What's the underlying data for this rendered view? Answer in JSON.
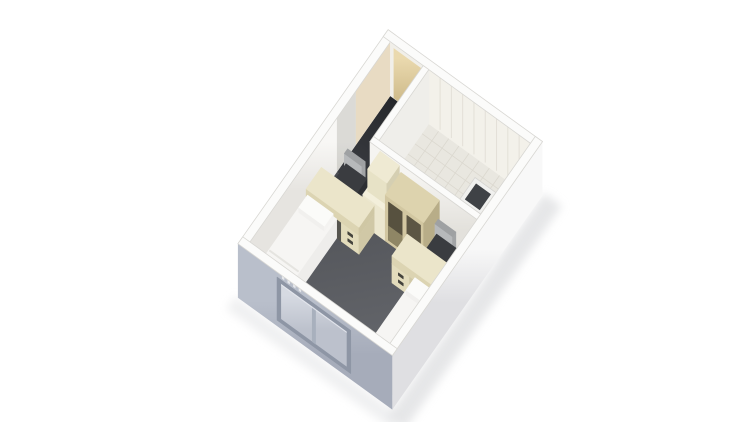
{
  "scene": {
    "name": "isometric-room-rendering",
    "canvas": {
      "width": 750,
      "height": 422,
      "background": "#ffffff"
    },
    "projection": {
      "origin": [
        250,
        296
      ],
      "eu": [
        0.54,
        -0.77
      ],
      "ev": [
        0.8,
        0.58
      ]
    },
    "room": {
      "interior_length": 260,
      "interior_width": 175,
      "wall_thickness": 9,
      "wall_height": 54
    },
    "palette": {
      "carpet_dark": "#4f5156",
      "carpet_light": "#696b70",
      "corridor_dark": "#26282c",
      "corridor_light": "#3b3d42",
      "wall_white": "#f3f2ef",
      "wall_top": "#fbfbfa",
      "wall_edge": "#d8d7d3",
      "tile_floor": "#e9e7e0",
      "tile_line": "#dbd8cf",
      "window_wall": "#aeb4c1",
      "window_frame": "#8e96a5",
      "window_pane": "#c9cdd7",
      "door_tan": "#dcc99c",
      "bed_white": "#f6f5f3",
      "desk_cream": "#ebe5ca",
      "chair_dark": "#3a3c40",
      "chair_back_gray": "#b7b9bb",
      "wardrobe_tan": "#d2c7a1",
      "shaft_dark": "#3f4246"
    },
    "gradients": [
      {
        "id": "gCarpet",
        "from": [
          161,
          10,
          0
        ],
        "to": [
          0,
          170,
          0
        ],
        "c1": "#4f5156",
        "c2": "#696b70"
      },
      {
        "id": "gCorridor",
        "from": [
          260,
          20,
          0
        ],
        "to": [
          161,
          20,
          0
        ],
        "c1": "#26282c",
        "c2": "#3b3d42"
      },
      {
        "id": "gLeftWall",
        "from": [
          130,
          0,
          54
        ],
        "to": [
          130,
          0,
          4
        ],
        "c1": "#f8f7f5",
        "c2": "#e6e4e0"
      },
      {
        "id": "gDoor",
        "from": [
          260,
          22,
          50
        ],
        "to": [
          260,
          22,
          0
        ],
        "c1": "#ead9ae",
        "c2": "#c9b584"
      },
      {
        "id": "gFrontPart",
        "from": [
          161,
          100,
          54
        ],
        "to": [
          161,
          100,
          0
        ],
        "c1": "#f5f4f1",
        "c2": "#e3e1dc"
      },
      {
        "id": "gRightWall",
        "from": [
          130,
          184,
          54
        ],
        "to": [
          130,
          184,
          0
        ],
        "c1": "#f8f8f8",
        "c2": "#dfdfe2"
      },
      {
        "id": "gWinWall",
        "from": [
          -9,
          90,
          54
        ],
        "to": [
          -9,
          90,
          0
        ],
        "c1": "#b9bfcb",
        "c2": "#a6acba"
      },
      {
        "id": "gPane",
        "from": [
          -9,
          65,
          45
        ],
        "to": [
          -9,
          65,
          10
        ],
        "c1": "#d6dae2",
        "c2": "#bcc1cc"
      }
    ],
    "objects": [
      {
        "name": "ground-shadow-right",
        "type": "flat",
        "rect": [
          -18,
          184,
          272,
          206
        ],
        "z": 0,
        "fill": "#dcdddf",
        "opacity": 0.7,
        "blur": true,
        "stroke": "none"
      },
      {
        "name": "ground-shadow-front",
        "type": "flat",
        "rect": [
          -26,
          -12,
          -9,
          196
        ],
        "z": 0,
        "fill": "#e3e4e6",
        "opacity": 0.55,
        "blur": true,
        "stroke": "none"
      },
      {
        "name": "main-room-carpet",
        "type": "flat",
        "rect": [
          0,
          0,
          161,
          175
        ],
        "z": 0,
        "fill": "g:gCarpet"
      },
      {
        "name": "carpet-shadow-left-wall",
        "type": "flat",
        "rect": [
          0,
          0,
          161,
          5
        ],
        "z": 0.2,
        "fill": "#44464a",
        "opacity": 0.5,
        "stroke": "none"
      },
      {
        "name": "carpet-shadow-window-wall",
        "type": "flat",
        "rect": [
          0,
          0,
          4,
          175
        ],
        "z": 0.2,
        "fill": "#4a4c50",
        "opacity": 0.4,
        "stroke": "none"
      },
      {
        "name": "entry-corridor-floor",
        "type": "flat",
        "rect": [
          161,
          0,
          260,
          41
        ],
        "z": 0,
        "fill": "g:gCorridor"
      },
      {
        "name": "bathroom-tile-floor",
        "type": "flat",
        "rect": [
          168,
          48,
          260,
          175
        ],
        "z": 0,
        "fill": "#e9e7e0"
      },
      {
        "name": "bathroom-floor-tile-grid",
        "type": "grid",
        "rect": [
          168,
          48,
          260,
          175
        ],
        "z": 0.3,
        "nu": 7,
        "nv": 10,
        "stroke": "#dbd8cf",
        "sw": 0.8
      },
      {
        "name": "left-wall-interior-face",
        "type": "faceV",
        "v": 0,
        "u0": 0,
        "u1": 260,
        "z0": 0,
        "z1": 54,
        "fill": "g:gLeftWall"
      },
      {
        "name": "left-wall-corridor-shade",
        "type": "faceV",
        "v": 0,
        "u0": 161,
        "u1": 196,
        "z0": 0,
        "z1": 54,
        "fill": "#5a564e",
        "opacity": 0.18,
        "stroke": "none"
      },
      {
        "name": "left-wall-door-light",
        "type": "faceV",
        "v": 0,
        "u0": 196,
        "u1": 260,
        "z0": 0,
        "z1": 54,
        "fill": "#d8c092",
        "opacity": 0.5,
        "stroke": "none"
      },
      {
        "name": "left-wall-top",
        "type": "flat",
        "rect": [
          -9,
          -9,
          269,
          0
        ],
        "z": 54,
        "fill": "#fbfbfa",
        "stroke": "#d8d7d3",
        "sw": 0.8
      },
      {
        "name": "back-wall-interior-face",
        "type": "faceU",
        "u": 260,
        "v0": 0,
        "v1": 175,
        "z0": 0,
        "z1": 54,
        "fill": "#f1efe9"
      },
      {
        "name": "entry-door",
        "type": "faceU",
        "u": 260,
        "v0": 4,
        "v1": 40,
        "z0": 0,
        "z1": 50,
        "fill": "g:gDoor"
      },
      {
        "name": "bathroom-back-wall-tiles",
        "type": "faceU",
        "u": 260,
        "v0": 48,
        "v1": 175,
        "z0": 0,
        "z1": 54,
        "fill": "#f3f1ea"
      },
      {
        "name": "bathroom-back-wall-panel-lines",
        "type": "linesU",
        "u": 260,
        "v0": 48,
        "v1": 175,
        "z0": 2,
        "z1": 54,
        "n": 8,
        "stroke": "#e3e0d7",
        "sw": 1
      },
      {
        "name": "back-wall-top",
        "type": "flat",
        "rect": [
          260,
          -9,
          269,
          184
        ],
        "z": 54,
        "fill": "#fbfbfa",
        "stroke": "#d8d7d3",
        "sw": 0.8
      },
      {
        "name": "bathroom-left-partition-face",
        "type": "faceV",
        "v": 48,
        "u0": 168,
        "u1": 260,
        "z0": 0,
        "z1": 54,
        "fill": "#efeeea"
      },
      {
        "name": "bathroom-left-partition-top",
        "type": "flat",
        "rect": [
          168,
          41,
          260,
          48
        ],
        "z": 54,
        "fill": "#fbfbfa",
        "stroke": "#d8d7d3",
        "sw": 0.8
      },
      {
        "name": "bathroom-front-partition-face",
        "type": "faceU",
        "u": 161,
        "v0": 41,
        "v1": 175,
        "z0": 0,
        "z1": 54,
        "fill": "g:gFrontPart"
      },
      {
        "name": "bathroom-front-partition-top",
        "type": "flat",
        "rect": [
          161,
          41,
          168,
          175
        ],
        "z": 54,
        "fill": "#fbfbfa",
        "stroke": "#d8d7d3",
        "sw": 0.8
      },
      {
        "name": "service-shaft-top-rim",
        "type": "flat",
        "rect": [
          168,
          149,
          196,
          175
        ],
        "z": 54,
        "fill": "#f0f0ee",
        "stroke": "#d6d5d2",
        "sw": 0.8
      },
      {
        "name": "service-shaft-dark-interior",
        "type": "flat",
        "rect": [
          172,
          153,
          192,
          171
        ],
        "z": 53,
        "fill": "#3f4246"
      },
      {
        "name": "fridge-unit",
        "type": "box",
        "rect": [
          132,
          52,
          161,
          80
        ],
        "z0": 0,
        "h": 30,
        "top": "#f3efdb",
        "front": "#ece7cf",
        "side": "#d9d3b8"
      },
      {
        "name": "fridge-top-cabinet",
        "type": "box",
        "rect": [
          138,
          54,
          161,
          78
        ],
        "z0": 30,
        "h": 22,
        "top": "#efead3",
        "front": "#e7e2c6",
        "side": "#d5cfb2"
      },
      {
        "name": "wardrobe-shelving",
        "type": "box",
        "rect": [
          132,
          80,
          161,
          128
        ],
        "z0": 0,
        "h": 46,
        "top": "#ddd3ae",
        "front": "#d2c7a1",
        "side": "#b8ad88"
      },
      {
        "name": "wardrobe-cubby-opening-1",
        "type": "faceU",
        "u": 132,
        "v0": 84,
        "v1": 101,
        "z0": 3,
        "z1": 41,
        "fill": "#57513f"
      },
      {
        "name": "wardrobe-cubby-shelf-1",
        "type": "faceU",
        "u": 132,
        "v0": 84,
        "v1": 101,
        "z0": 3,
        "z1": 17,
        "fill": "#8f8665"
      },
      {
        "name": "wardrobe-cubby-opening-2",
        "type": "faceU",
        "u": 132,
        "v0": 107,
        "v1": 124,
        "z0": 3,
        "z1": 41,
        "fill": "#5c5644"
      },
      {
        "name": "wardrobe-cubby-shelf-2",
        "type": "faceU",
        "u": 132,
        "v0": 107,
        "v1": 124,
        "z0": 3,
        "z1": 17,
        "fill": "#978d6b"
      },
      {
        "name": "desk-chair-1-backrest",
        "type": "box",
        "rect": [
          154,
          14,
          160,
          36
        ],
        "z0": 14,
        "h": 18,
        "top": "#9fa1a3",
        "front": "#b7b9bb",
        "side": "#a2a4a6"
      },
      {
        "name": "desk-chair-1-seat",
        "type": "box",
        "rect": [
          134,
          12,
          160,
          38
        ],
        "z0": 8,
        "h": 8,
        "top": "#3a3c40",
        "front": "#333539",
        "side": "#2d2f33"
      },
      {
        "name": "desk-1-under-shadow",
        "type": "faceU",
        "u": 104,
        "v0": 37,
        "v1": 45,
        "z0": 0,
        "z1": 19,
        "fill": "#56554f"
      },
      {
        "name": "desk-1-drawer-unit",
        "type": "box",
        "rect": [
          104,
          44,
          132,
          66
        ],
        "z0": 0,
        "h": 19,
        "top": "#e3dcbc",
        "front": "#e3dcbc",
        "side": "#d0c8a6"
      },
      {
        "name": "desk-1-top-slab",
        "type": "box",
        "rect": [
          104,
          0,
          132,
          66
        ],
        "z0": 19,
        "h": 8,
        "top": "#ebe5ca",
        "front": "#dcd4b2",
        "side": "#cfc7a4"
      },
      {
        "name": "desk-1-drawer-handle-upper",
        "type": "faceU",
        "u": 104,
        "v0": 52,
        "v1": 58,
        "z0": 12,
        "z1": 14.5,
        "fill": "#44433c"
      },
      {
        "name": "desk-1-drawer-handle-lower",
        "type": "faceU",
        "u": 104,
        "v0": 52,
        "v1": 58,
        "z0": 5,
        "z1": 7.5,
        "fill": "#44433c"
      },
      {
        "name": "desk-chair-2-backrest",
        "type": "box",
        "rect": [
          150,
          130,
          156,
          152
        ],
        "z0": 14,
        "h": 18,
        "top": "#9fa1a3",
        "front": "#b7b9bb",
        "side": "#a2a4a6"
      },
      {
        "name": "desk-chair-2-seat",
        "type": "box",
        "rect": [
          130,
          128,
          156,
          154
        ],
        "z0": 8,
        "h": 8,
        "top": "#3a3c40",
        "front": "#333539",
        "side": "#2d2f33"
      },
      {
        "name": "desk-2-under-shadow",
        "type": "faceU",
        "u": 100,
        "v0": 131,
        "v1": 139,
        "z0": 0,
        "z1": 19,
        "fill": "#56554f"
      },
      {
        "name": "desk-2-drawer-unit",
        "type": "box",
        "rect": [
          100,
          110,
          128,
          132
        ],
        "z0": 0,
        "h": 19,
        "top": "#e3dcbc",
        "front": "#e3dcbc",
        "side": "#d0c8a6"
      },
      {
        "name": "desk-2-top-slab",
        "type": "box",
        "rect": [
          100,
          110,
          128,
          175
        ],
        "z0": 19,
        "h": 8,
        "top": "#ebe5ca",
        "front": "#dcd4b2",
        "side": "#cfc7a4"
      },
      {
        "name": "desk-2-drawer-handle-upper",
        "type": "faceU",
        "u": 100,
        "v0": 118,
        "v1": 124,
        "z0": 12,
        "z1": 14.5,
        "fill": "#44433c"
      },
      {
        "name": "desk-2-drawer-handle-lower",
        "type": "faceU",
        "u": 100,
        "v0": 118,
        "v1": 124,
        "z0": 5,
        "z1": 7.5,
        "fill": "#44433c"
      },
      {
        "name": "bed-1",
        "type": "box",
        "rect": [
          6,
          0,
          104,
          38
        ],
        "z0": 0,
        "h": 19,
        "top": "#f6f5f3",
        "front": "#e8e7e4",
        "side": "#eeedeb"
      },
      {
        "name": "bed-1-pillow",
        "type": "box",
        "rect": [
          86,
          3,
          102,
          35
        ],
        "z0": 19,
        "h": 5,
        "top": "#fbfbf9",
        "front": "#f1f0ee",
        "side": "#f4f3f1"
      },
      {
        "name": "bed-1-duvet-fold-a",
        "type": "flat",
        "rect": [
          24,
          1,
          25.6,
          37
        ],
        "z": 19.3,
        "fill": "#e1e0dc"
      },
      {
        "name": "bed-1-duvet-fold-b",
        "type": "flat",
        "rect": [
          34,
          1,
          35.4,
          37
        ],
        "z": 19.3,
        "fill": "#e5e4e0"
      },
      {
        "name": "bed-2",
        "type": "box",
        "rect": [
          4,
          137,
          100,
          175
        ],
        "z0": 0,
        "h": 19,
        "top": "#f6f5f3",
        "front": "#e8e7e4",
        "side": "#eeedeb"
      },
      {
        "name": "bed-2-pillow",
        "type": "box",
        "rect": [
          82,
          140,
          98,
          172
        ],
        "z0": 19,
        "h": 5,
        "top": "#fbfbf9",
        "front": "#f1f0ee",
        "side": "#f4f3f1"
      },
      {
        "name": "bed-2-duvet-fold",
        "type": "flat",
        "rect": [
          20,
          138,
          21.6,
          174
        ],
        "z": 19.3,
        "fill": "#e1e0dc"
      },
      {
        "name": "right-wall-exterior-face",
        "type": "faceV",
        "v": 184,
        "u0": -9,
        "u1": 269,
        "z0": 0,
        "z1": 54,
        "fill": "g:gRightWall"
      },
      {
        "name": "right-wall-top",
        "type": "flat",
        "rect": [
          -9,
          175,
          269,
          184
        ],
        "z": 54,
        "fill": "#fbfbfa",
        "stroke": "#d8d7d3",
        "sw": 0.8
      },
      {
        "name": "window-wall-exterior-face",
        "type": "faceU",
        "u": -9,
        "v0": -9,
        "v1": 184,
        "z0": 0,
        "z1": 54,
        "fill": "g:gWinWall"
      },
      {
        "name": "window-frame",
        "type": "faceU",
        "u": -9,
        "v0": 40,
        "v1": 132,
        "z0": 6,
        "z1": 49,
        "fill": "#8e96a5"
      },
      {
        "name": "window-pane-left",
        "type": "faceU",
        "u": -9,
        "v0": 45,
        "v1": 84,
        "z0": 10,
        "z1": 45,
        "fill": "g:gPane"
      },
      {
        "name": "window-pane-right",
        "type": "faceU",
        "u": -9,
        "v0": 88,
        "v1": 127,
        "z0": 10,
        "z1": 45,
        "fill": "g:gPane"
      },
      {
        "name": "window-sash-divider",
        "type": "faceU",
        "u": -9,
        "v0": 84,
        "v1": 88,
        "z0": 10,
        "z1": 45,
        "fill": "#a8b0bd"
      },
      {
        "name": "window-top-highlight",
        "type": "faceU",
        "u": -9,
        "v0": 45,
        "v1": 127,
        "z0": 43.6,
        "z1": 45,
        "fill": "#e4e7ed",
        "opacity": 0.9,
        "stroke": "none"
      },
      {
        "name": "window-vent-tick-1",
        "type": "faceU",
        "u": -9,
        "v0": 46,
        "v1": 49,
        "z0": 51,
        "z1": 54.5,
        "fill": "#e6e8ec",
        "stroke": "none"
      },
      {
        "name": "window-vent-tick-2",
        "type": "faceU",
        "u": -9,
        "v0": 53,
        "v1": 56,
        "z0": 51,
        "z1": 54.5,
        "fill": "#e6e8ec",
        "stroke": "none"
      },
      {
        "name": "window-vent-tick-3",
        "type": "faceU",
        "u": -9,
        "v0": 60,
        "v1": 63,
        "z0": 51,
        "z1": 54.5,
        "fill": "#e6e8ec",
        "stroke": "none"
      },
      {
        "name": "window-vent-tick-4",
        "type": "faceU",
        "u": -9,
        "v0": 67,
        "v1": 70,
        "z0": 51,
        "z1": 54.5,
        "fill": "#e6e8ec",
        "stroke": "none"
      },
      {
        "name": "window-wall-top",
        "type": "flat",
        "rect": [
          -9,
          -9,
          0,
          184
        ],
        "z": 54,
        "fill": "#fbfbfa",
        "stroke": "#d8d7d3",
        "sw": 0.8
      }
    ]
  }
}
